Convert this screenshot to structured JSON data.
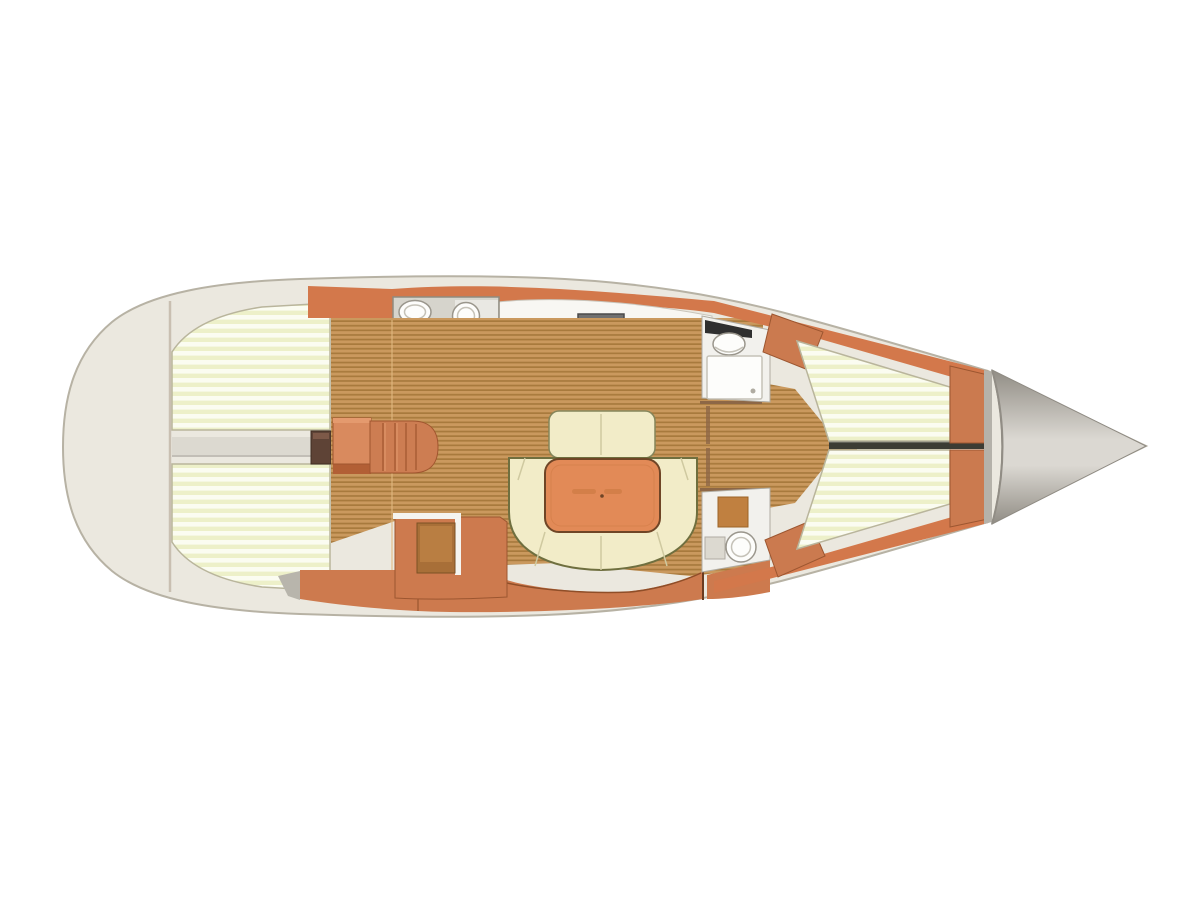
{
  "diagram": {
    "kind": "sailboat-interior-floorplan",
    "orientation": "bow-right",
    "regions": [
      "aft-cabin-port-berth",
      "aft-cabin-starboard-berth",
      "aft-head-bathroom",
      "galley",
      "salon-dinette",
      "companionway-stairs",
      "nav-station",
      "forward-head-vanity",
      "forward-head-toilet",
      "forward-cabin-v-berth",
      "bow-anchor-locker"
    ]
  },
  "colors": {
    "bg": "#ffffff",
    "hull_fill": "#ebe8df",
    "hull_stroke": "#b7b2a4",
    "transom_line": "#c9bfb1",
    "mattress_light": "#fbfcf1",
    "mattress_shade": "#edf0c9",
    "mattress_edge": "#b9b59c",
    "corridor_gray": "#dcd9d0",
    "corridor_line": "#b9b6ad",
    "box_dark": "#5e4336",
    "box_dark_hi": "#7d5948",
    "box_dark_edge": "#3f2d22",
    "orange_wall": "#d3784b",
    "orange_wall_edge": "#9c5630",
    "galley_white": "#f8f7f3",
    "galley_edge": "#c9c5bb",
    "head_floor": "#d6d4cc",
    "head_floor_light": "#e9e8e3",
    "head_edge": "#8f8b80",
    "fixture_white": "#fdfdfb",
    "fixture_edge": "#9a968c",
    "fixture_inner": "#c5c2b8",
    "rail_gray": "#8a8678",
    "mat_wood": "#c08040",
    "mat_wood_edge": "#9c6426",
    "stove_body": "#707070",
    "stove_edge": "#4a4a4a",
    "burner_dark": "#3e3e3e",
    "burner_mid": "#565656",
    "burner_ring": "#9a9a9a",
    "lid_white": "#fcfbf9",
    "lid_edge": "#b5b1a7",
    "sink_white": "#f4f3ef",
    "sink_edge": "#6e6a60",
    "wood_base": "#ca995e",
    "wood_stripe": "#a87a3d",
    "wood_seam": "#e2ba81",
    "doorframe": "#8d6746",
    "band_orange": "#cd7a4e",
    "band_seam": "#8f4e28",
    "band_right_edge": "#6b3b20",
    "gray_wedge": "#b8b5ac",
    "trim_white": "#f5f4ef",
    "chart_brown": "#a86f38",
    "chart_brown_hi": "#b97e42",
    "chart_edge": "#7c5124",
    "stairs_light": "#d98a5e",
    "stairs_mid": "#cd7d52",
    "stairs_edge": "#a0552f",
    "stairs_hi": "#e49a6e",
    "stairs_shadow": "#b25f35",
    "seat_cream": "#f2ecc8",
    "seat_edge": "#85855a",
    "seat_seam": "#cfc9a0",
    "settee_border": "#6f6f3f",
    "table_orange": "#e28a57",
    "table_edge": "#6f4526",
    "table_detail": "#d07c46",
    "room_white": "#f2f1ed",
    "room_edge": "#b0aca2",
    "counter_dark": "#2f2f2f",
    "door_orange": "#cb7a4f",
    "berth_split": "#3c3c34",
    "berth_split_hi": "#8a8a80",
    "bulkhead_gray": "#b5b2aa",
    "cone_dark": "#918d85",
    "cone_light": "#dbd8d2",
    "cone_edge": "#8f8b83"
  }
}
